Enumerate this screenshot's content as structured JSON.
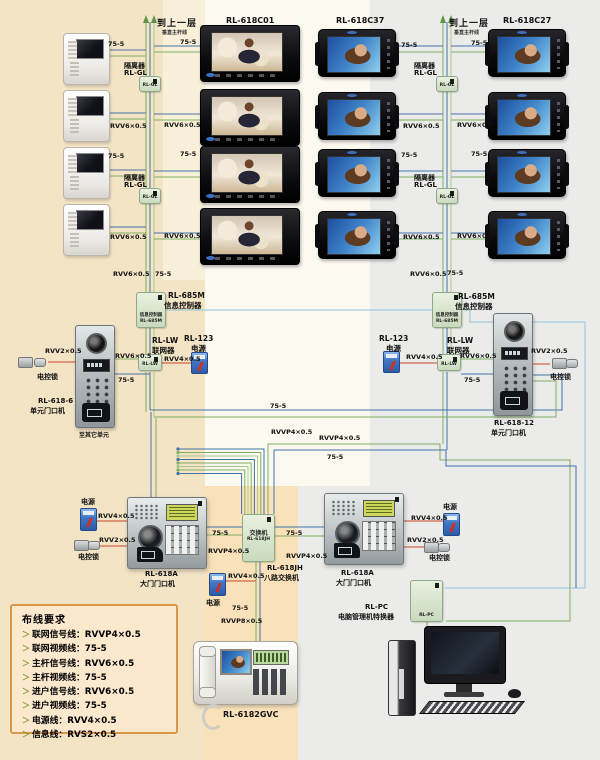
{
  "titles": {
    "c01": "RL-618C01",
    "c37": "RL-618C37",
    "c27": "RL-618C27"
  },
  "trunk": {
    "to_upper": "到上一层",
    "sub": "垂直主杆线"
  },
  "labels": {
    "iso": "隔离器",
    "rl_gl": "RL-GL",
    "rl685m": "RL-685M",
    "info_ctrl": "信息控制器",
    "rl_lw": "RL-LW",
    "networker": "联网器",
    "rl123": "RL-123",
    "power": "电源",
    "lock": "电控锁",
    "rl6186": "RL-618-6",
    "rl61812": "RL-618-12",
    "unit_door": "单元门口机",
    "other_units": "至其它单元",
    "rl618a": "RL-618A",
    "gate_door": "大门门口机",
    "switch_cn": "交换机",
    "rl618jh": "RL-618JH",
    "eight_switch": "八路交换机",
    "rlpc": "RL-PC",
    "pc_conv": "电脑管理机特换器",
    "phone_model": "RL-6182GVC"
  },
  "wires": {
    "w75": "75-5",
    "rvv6": "RVV6×0.5",
    "rvv4": "RVV4×0.5",
    "rvv2": "RVV2×0.5",
    "rvvp4": "RVVP4×0.5",
    "rvvp8": "RVVP8×0.5",
    "rvs2": "RVS2×0.5"
  },
  "requirements": {
    "title": "布线要求",
    "items": [
      "联网信号线：RVVP4×0.5",
      "联网视频线：75-5",
      "主杆信号线：RVV6×0.5",
      "主杆视频线：75-5",
      "进户信号线：RVV6×0.5",
      "进户视频线：75-5",
      "电源线：RVV4×0.5",
      "信息线：RVS2×0.5"
    ]
  },
  "colors": {
    "signal_green": "#7fae63",
    "signal_green2": "#a9c98c",
    "video_blue": "#4472a8",
    "info_lightblue": "#8fc3dc",
    "power_red": "#c8452a",
    "bg_beige": "#f3e4c5",
    "bg_peach": "#f9e2ba",
    "bg_gray": "#ebecea",
    "mint": "#d9e7cd"
  }
}
